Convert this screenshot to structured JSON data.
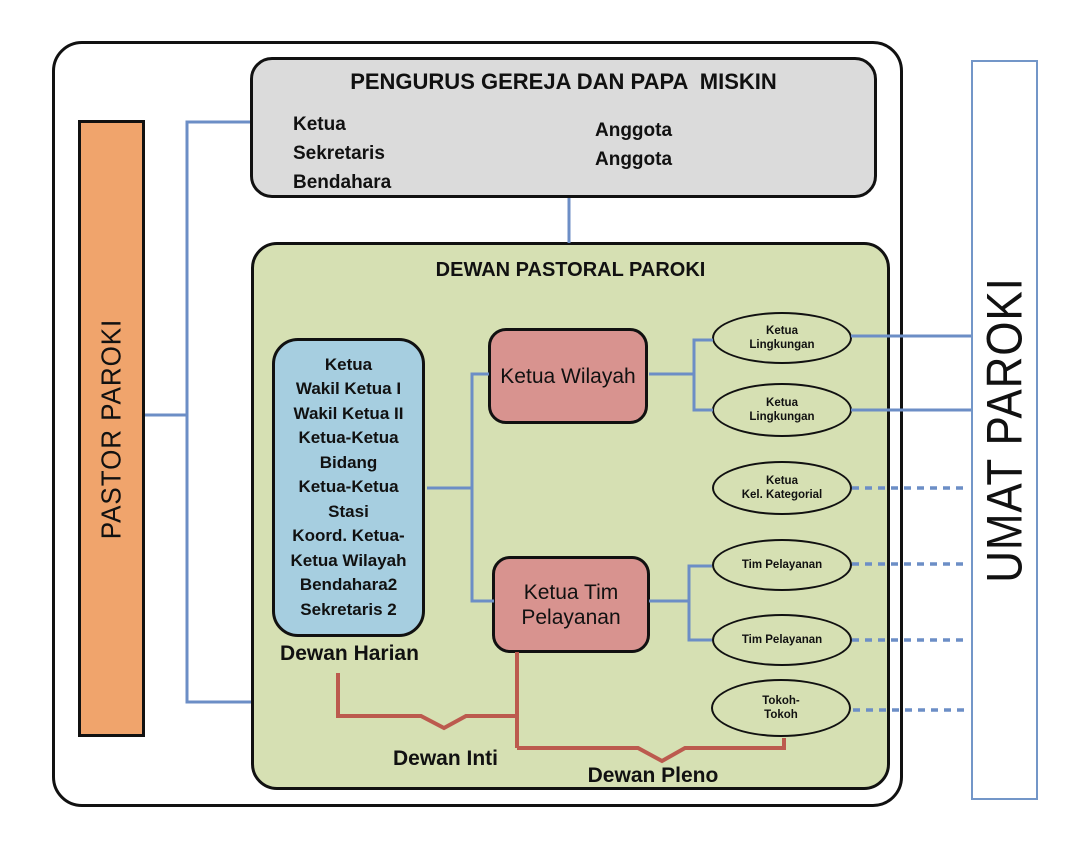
{
  "palette": {
    "orange_fill": "#F0A46C",
    "gray_fill": "#DBDBDB",
    "green_fill": "#D6E0B3",
    "blue_fill": "#A6CEE0",
    "pink_fill": "#D8938F",
    "connector_blue": "#6C8EC6",
    "connector_red": "#BC5A4E",
    "umat_border_blue": "#7396C8",
    "border_black": "#111111"
  },
  "left_bar": {
    "label": "PASTOR PAROKI"
  },
  "right_bar": {
    "label": "UMAT PAROKI"
  },
  "pengurus_box": {
    "title": "PENGURUS GEREJA DAN PAPA  MISKIN",
    "left_roles": [
      "Ketua",
      "Sekretaris",
      "Bendahara"
    ],
    "right_roles": [
      "Anggota",
      "Anggota"
    ]
  },
  "dewan_pastoral_box": {
    "title": "DEWAN PASTORAL PAROKI"
  },
  "dewan_harian_box": {
    "lines": [
      "Ketua",
      "Wakil Ketua I",
      "Wakil Ketua II",
      "Ketua-Ketua",
      "Bidang",
      "Ketua-Ketua",
      "Stasi",
      "Koord. Ketua-",
      "Ketua Wilayah",
      "Bendahara2",
      "Sekretaris 2"
    ],
    "caption": "Dewan Harian"
  },
  "ketua_wilayah_box": {
    "label": "Ketua Wilayah"
  },
  "ketua_tim_box": {
    "line1": "Ketua Tim",
    "line2": "Pelayanan"
  },
  "ellipses": [
    {
      "line1": "Ketua",
      "line2": "Lingkungan"
    },
    {
      "line1": "Ketua",
      "line2": "Lingkungan"
    },
    {
      "line1": "Ketua",
      "line2": "Kel. Kategorial"
    },
    {
      "line1": "Tim Pelayanan",
      "line2": ""
    },
    {
      "line1": "Tim Pelayanan",
      "line2": ""
    },
    {
      "line1": "Tokoh-",
      "line2": "Tokoh"
    }
  ],
  "captions": {
    "dewan_inti": "Dewan Inti",
    "dewan_pleno": "Dewan Pleno"
  }
}
